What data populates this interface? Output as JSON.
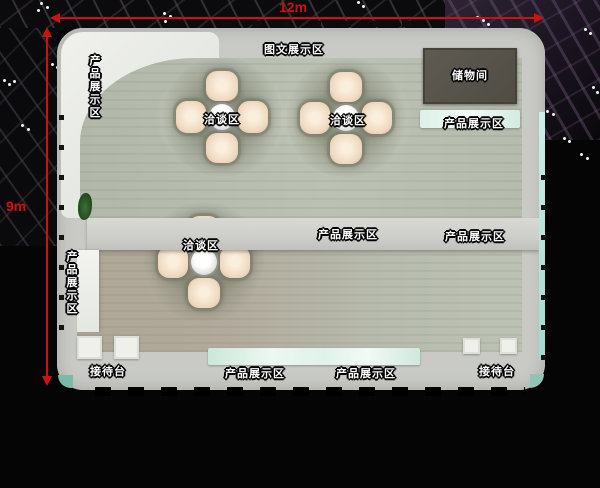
{
  "dimensions": {
    "width": "12m",
    "height": "9m"
  },
  "labels": {
    "graphic_display": "图文展示区",
    "storage_room": "储物间",
    "product_left_top": "产品展示区",
    "product_left_bottom": "产品展示区",
    "product_right_top": "产品展示区",
    "product_mid_center": "产品展示区",
    "product_mid_right": "产品展示区",
    "product_bottom_1": "产品展示区",
    "product_bottom_2": "产品展示区",
    "negotiation_1": "洽谈区",
    "negotiation_2": "洽谈区",
    "negotiation_3": "洽谈区",
    "reception_left": "接待台",
    "reception_right": "接待台"
  },
  "colors": {
    "dimension_line": "#cf1010",
    "booth_wall": "#c9cac5",
    "floor": "#b5bbad",
    "storage_room": "#56534b",
    "counter_teal": "#dff2ea",
    "chair_petal": "#f0d9c0",
    "background": "#050506"
  }
}
